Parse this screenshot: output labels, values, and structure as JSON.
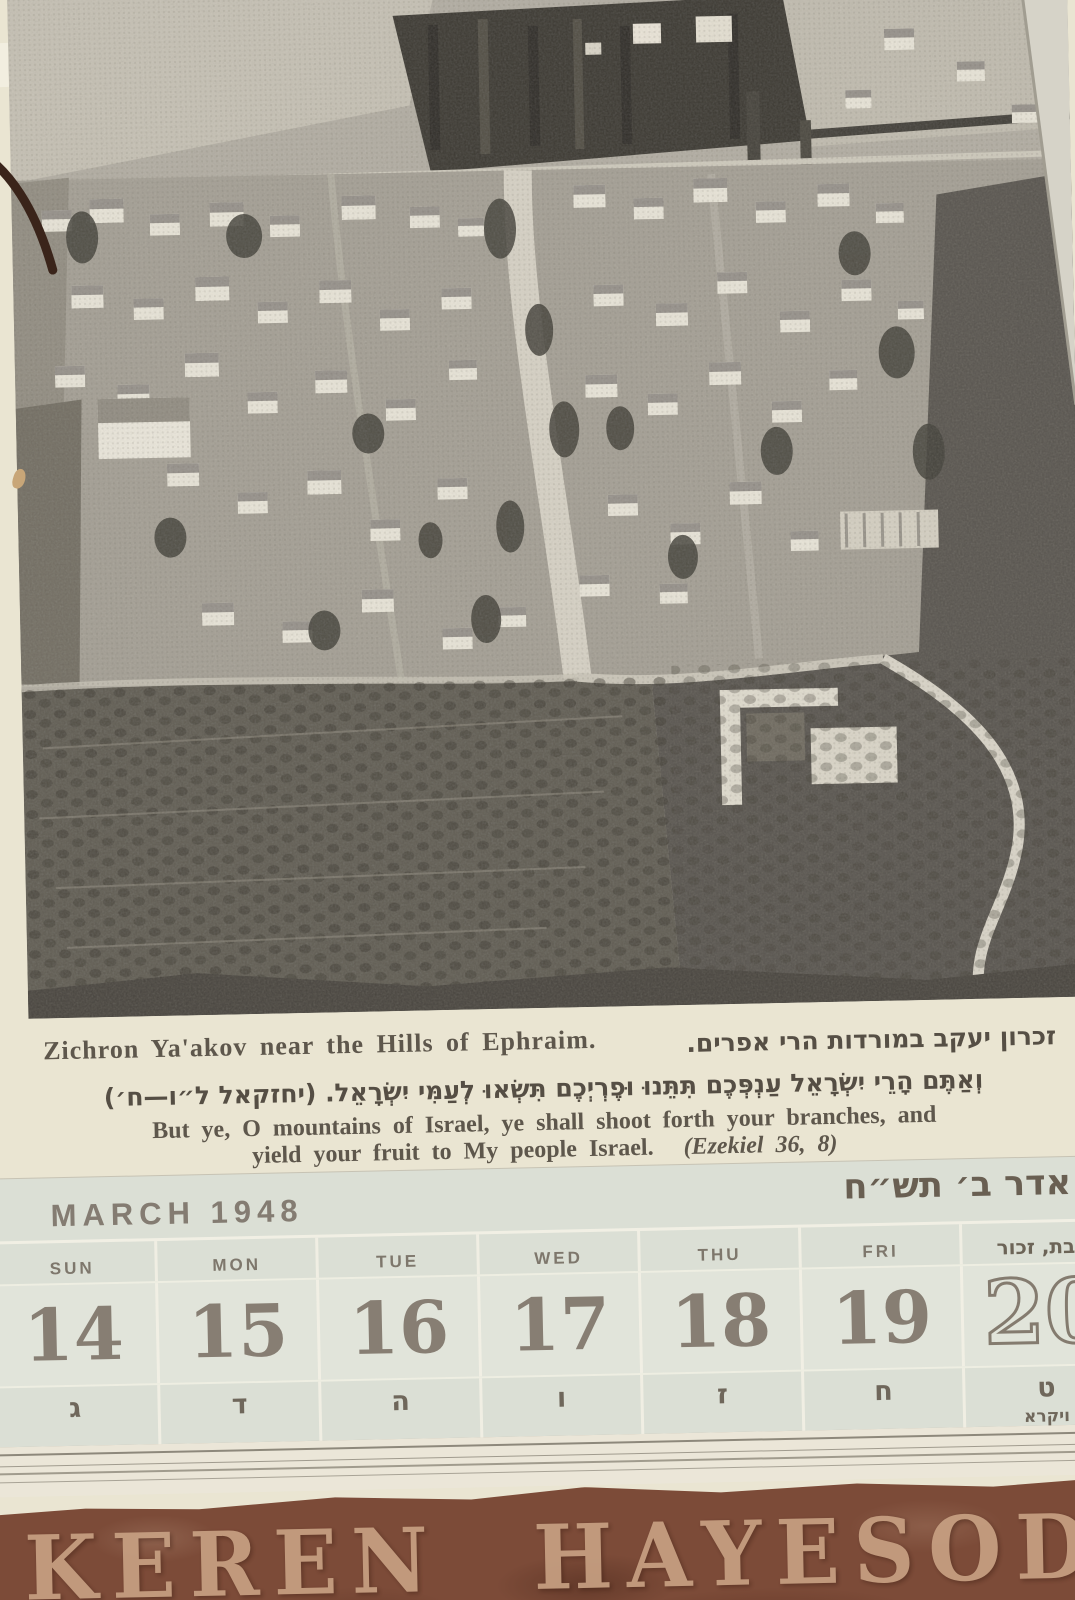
{
  "photo": {
    "description": "Black-and-white halftone aerial photograph of the village of Zichron Ya'akov: white houses with gabled roofs along a central street, dark tree groves and orchard slopes, winding roads at lower right"
  },
  "caption": {
    "english": "Zichron Ya'akov near the Hills of Ephraim.",
    "hebrew": "זכרון יעקב במורדות הרי אפרים."
  },
  "verse": {
    "hebrew": "וְאַתֶּם הָרֵי יִשְׂרָאֵל עַנְפְּכֶם תִּתֵּנוּ וּפֶרְיְכֶם תִּשְׂאוּ לְעַמִּי יִשְׂרָאֵל. (יחזקאל ל״ו—ח׳)",
    "english_line1": "But ye, O mountains of Israel, ye shall shoot forth your branches, and",
    "english_line2": "yield your fruit to My people Israel.",
    "english_source": "(Ezekiel 36, 8)"
  },
  "calendar": {
    "month_title": "MARCH 1948",
    "hebrew_month": "אדר ב׳ תש״ח",
    "days": [
      {
        "day_name": "SUN",
        "date": "14",
        "hebrew_date": "ג"
      },
      {
        "day_name": "MON",
        "date": "15",
        "hebrew_date": "ד"
      },
      {
        "day_name": "TUE",
        "date": "16",
        "hebrew_date": "ה"
      },
      {
        "day_name": "WED",
        "date": "17",
        "hebrew_date": "ו"
      },
      {
        "day_name": "THU",
        "date": "18",
        "hebrew_date": "ז"
      },
      {
        "day_name": "FRI",
        "date": "19",
        "hebrew_date": "ח"
      },
      {
        "day_name": "שבת, זכור",
        "date": "20",
        "hebrew_date": "ט",
        "torah_portion": "ויקרא"
      }
    ]
  },
  "footer": {
    "brand": "KEREN HAYESOD"
  },
  "colors": {
    "paper_cream": "#eae5d2",
    "calendar_band": "#dbdfd5",
    "calendar_ink": "#7e776c",
    "date_ink": "#877e73",
    "cover_brown": "#7c4b38",
    "brand_tan": "#c9a284"
  }
}
